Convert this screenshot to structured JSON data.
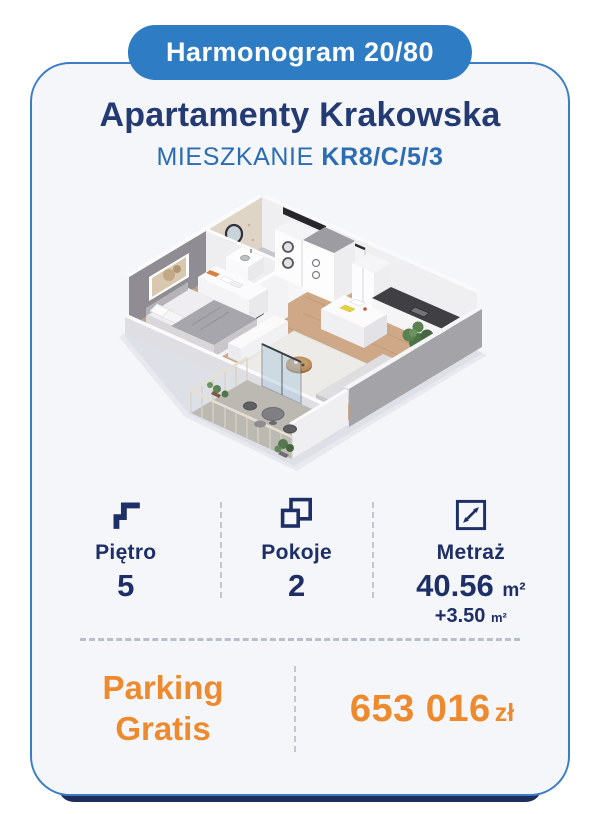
{
  "badge": {
    "label": "Harmonogram 20/80"
  },
  "header": {
    "title": "Apartamenty Krakowska",
    "subtitle_prefix": "MIESZKANIE",
    "subtitle_code": "KR8/C/5/3"
  },
  "stats": {
    "items": [
      {
        "icon": "stairs-icon",
        "label": "Piętro",
        "value": "5"
      },
      {
        "icon": "rooms-icon",
        "label": "Pokoje",
        "value": "2"
      },
      {
        "icon": "area-resize-icon",
        "label": "Metraż",
        "value": "40.56",
        "unit": "m²",
        "extra": "+3.50",
        "extra_unit": "m²"
      }
    ]
  },
  "footer": {
    "promo_line1": "Parking",
    "promo_line2": "Gratis",
    "price": "653 016",
    "currency": "zł"
  },
  "colors": {
    "badge_blue": "#2e7cc3",
    "title_navy": "#233a72",
    "subtitle_blue": "#2b6cb3",
    "stat_navy": "#1d2f66",
    "accent_orange": "#ee8a2e",
    "card_background": "#f5f6fa",
    "card_border_blue": "#3b7dc4",
    "divider_gray": "#c2c7d0",
    "bottom_bar_navy": "#1e2d5c"
  }
}
